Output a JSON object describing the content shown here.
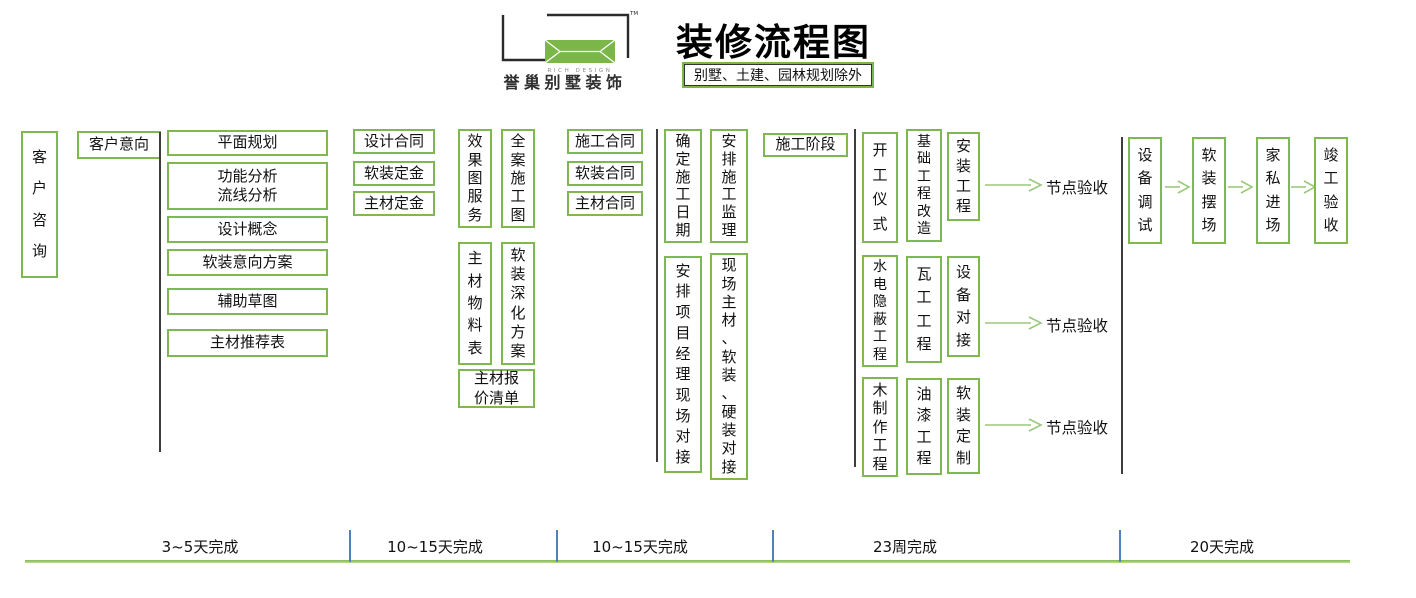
{
  "header": {
    "brand_cn": "誉巢别墅装饰",
    "brand_en": "RICH DESIGN",
    "tm": "TM",
    "title": "装修流程图",
    "subtitle": "别墅、土建、园林规划除外"
  },
  "colors": {
    "box_border_green": "#7fb750",
    "arrow_green": "#9cc87c",
    "timeline_green": "#84bb52",
    "tick_blue": "#4f81bd",
    "divider_dark": "#3d3d3d",
    "logo_green": "#7ab648"
  },
  "stage_consult": {
    "consult": "客户咨询",
    "intent": "客户意向",
    "items": [
      "平面规划",
      "功能分析\n流线分析",
      "设计概念",
      "软装意向方案",
      "辅助草图",
      "主材推荐表"
    ]
  },
  "stage_design_contract": {
    "items": [
      "设计合同",
      "软装定金",
      "主材定金"
    ]
  },
  "stage_deepen": {
    "v_items": [
      "效果图服务",
      "全案施工图",
      "主材物料表",
      "软装深化方案"
    ],
    "quote": "主材报\n价清单"
  },
  "stage_construct_contract": {
    "items": [
      "施工合同",
      "软装合同",
      "主材合同"
    ]
  },
  "stage_prepare": {
    "phase_label": "施工阶段",
    "v_items": [
      "确定施工日期",
      "安排施工监理",
      "安排项目经理现场对接",
      "现场主材、软装、硬装对接"
    ]
  },
  "stage_construction": {
    "row1": [
      "开工仪式",
      "基础工程改造",
      "安装工程"
    ],
    "row2": [
      "水电隐蔽工程",
      "瓦工工程",
      "设备对接"
    ],
    "row3": [
      "木制作工程",
      "油漆工程",
      "软装定制"
    ],
    "node_acceptance": "节点验收"
  },
  "stage_finish": {
    "v_items": [
      "设备调试",
      "软装摆场",
      "家私进场",
      "竣工验收"
    ]
  },
  "timeline": {
    "labels": [
      "3~5天完成",
      "10~15天完成",
      "10~15天完成",
      "23周完成",
      "20天完成"
    ]
  }
}
